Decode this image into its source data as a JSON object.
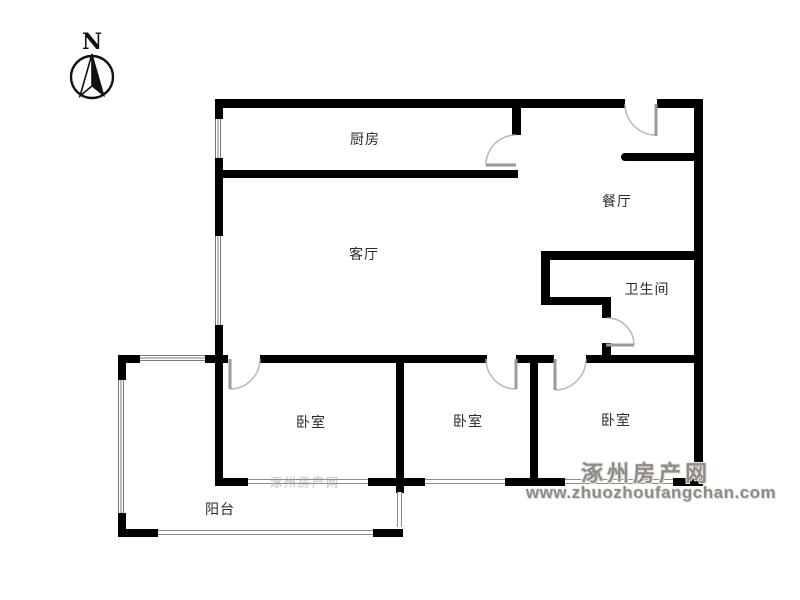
{
  "compass": {
    "north_label": "N"
  },
  "rooms": {
    "kitchen": "厨房",
    "dining_room": "餐厅",
    "living_room": "客厅",
    "bathroom": "卫生间",
    "bedroom_left": "卧室",
    "bedroom_middle": "卧室",
    "bedroom_right": "卧室",
    "balcony": "阳台"
  },
  "watermark": {
    "site_name": "涿州房产网",
    "site_url": "www.zhuozhoufangchan.com"
  },
  "colors": {
    "wall": "#000000",
    "door_symbol": "#b5b5b5",
    "window_symbol": "#8c8c8c",
    "room_label": "#2b2b2b",
    "watermark": "#8f8b87",
    "background": "#ffffff"
  }
}
